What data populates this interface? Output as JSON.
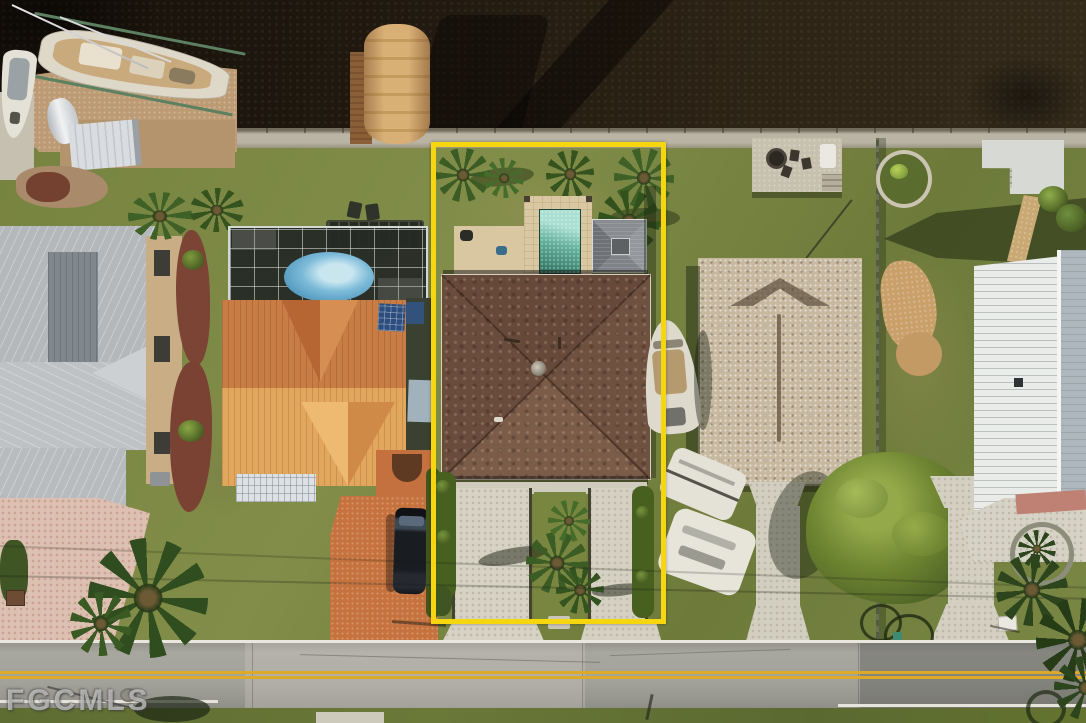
{
  "meta": {
    "type": "aerial-real-estate-photo",
    "width_px": 1086,
    "height_px": 723,
    "view": "top-down drone view of waterfront residential lots"
  },
  "watermark": {
    "text": "FGCMLS"
  },
  "property_outline": {
    "shape": "rectangle",
    "color": "#f6d60e",
    "left_px": 431,
    "top_px": 142,
    "width_px": 225,
    "height_px": 472
  },
  "scene": {
    "canal": {
      "position": "top",
      "water_color": "#241c12"
    },
    "seawall_color": "#bab4a4",
    "road": {
      "position": "bottom",
      "surface_color": "#a3a29a",
      "center_line": "double yellow",
      "center_line_color": "#dca928",
      "edge_line_color": "#eae8de"
    },
    "subject_property": {
      "outlined": true,
      "roof_color": "#6b4e3d",
      "pool_color": "#63b09c",
      "pool_deck_color": "#dac8a3",
      "features": [
        "rear lawn with palms",
        "rectangular pool",
        "travertine deck",
        "gray cabana",
        "brown shingle hip roof",
        "twin concrete driveways",
        "palm island between driveways",
        "hedges"
      ]
    },
    "neighbors": {
      "far_left": {
        "roof_color": "#b4b8bb",
        "features": [
          "gray metal roof house",
          "pink paver driveway",
          "red mulch beds",
          "large palm"
        ]
      },
      "left": {
        "roof_color": "#c97d45",
        "pool_color": "#7dbbd9",
        "features": [
          "orange metal roof house",
          "screened pool cage with oval pool",
          "solar panel",
          "orange paver driveway",
          "dark SUV"
        ]
      },
      "right": {
        "roof_color": "#c7b9a0",
        "features": [
          "tan shingle hip roof house",
          "waterfront patio with fire pit",
          "boat on lawn",
          "white boats on trailers",
          "large tree",
          "two driveways",
          "fence",
          "round garden bed"
        ]
      },
      "far_right": {
        "roof_color": "#eaece9",
        "features": [
          "white metal roof house",
          "concrete dock with steps",
          "paver path",
          "round planter",
          "palms"
        ]
      }
    },
    "waterfront_items": [
      "sailboat on lift",
      "small boat",
      "tan covered boat canopy",
      "docks",
      "storage shed",
      "covered dinghy"
    ]
  }
}
